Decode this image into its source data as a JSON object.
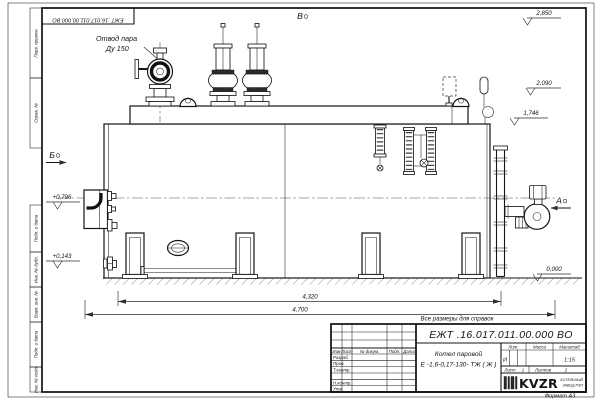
{
  "sheet": {
    "doc_number_top": "ЕЖТ .16.017.011.00.000  ВО",
    "reference_note": "Все размеры для справок",
    "format_label": "Формат А3"
  },
  "margin_boxes": [
    "Перв. примен.",
    "Справ. №",
    "Подп. и дата",
    "Инв. № дубл.",
    "Взам. инв. №",
    "Подп. и дата",
    "Инв. № подл."
  ],
  "labels": {
    "steam_outlet_1": "Отвод пара",
    "steam_outlet_2": "Ду 150",
    "view_top": "В",
    "view_left": "Б",
    "view_right": "А"
  },
  "elevations": {
    "e1": "2,850",
    "e2": "2,090",
    "e3": "1,746",
    "e4": "0,000",
    "e5": "+0,796",
    "e6": "+0,143"
  },
  "dimensions": {
    "overall_upper": "4,320",
    "overall_lower": "4,700"
  },
  "title_block": {
    "doc_number": "ЕЖТ .16.017.011.00.000  ВО",
    "product_name_1": "Котел паровой",
    "product_name_2": "Е -1,6-0,17-130- ТЖ ( Ж )",
    "col_izm": "Изм",
    "col_list": "Лист",
    "col_docnum": "№ докум.",
    "col_podp": "Подп.",
    "col_data": "Дата",
    "row_razrab": "Разраб.",
    "row_prov": "Пров.",
    "row_tkontr": "Т.контр.",
    "row_nkontr": "Н.контр.",
    "row_utv": "Утв.",
    "lit_header": "Лит.",
    "massa_header": "Масса",
    "masshtab_header": "Масштаб",
    "lit_value": "И",
    "scale_value": "1:15",
    "sheet_label": "Лист",
    "sheet_value": "1",
    "sheets_label": "Листов",
    "sheets_value": "2",
    "logo_text": "KVZR",
    "logo_sub_1": "КОТЕЛЬНЫЙ",
    "logo_sub_2": "ЗАВОД РЭП"
  }
}
